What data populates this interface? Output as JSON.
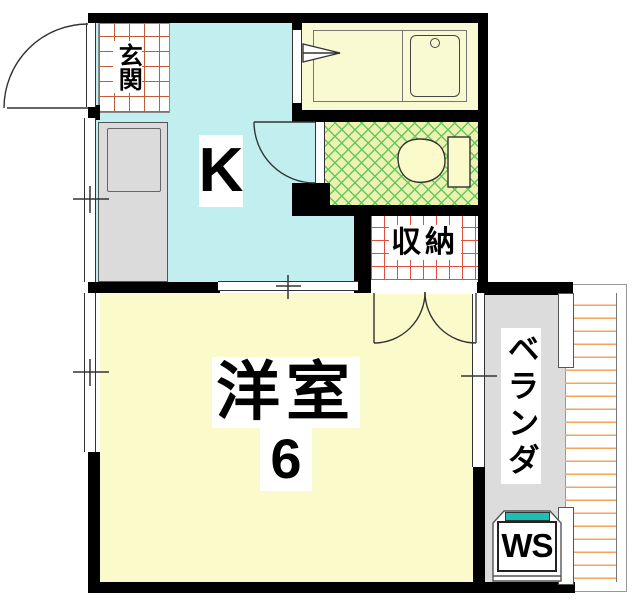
{
  "floorplan": {
    "labels": {
      "entrance": "玄関",
      "kitchen": "K",
      "closet": "収納",
      "main_room_name": "洋室",
      "main_room_size": "6",
      "balcony": "ベランダ",
      "washer_space": "WS"
    },
    "colors": {
      "kitchen_floor": "#c1efef",
      "room_floor": "#fafacb",
      "bathroom_floor": "#fafad2",
      "toilet_floor": "#f0f0b2",
      "toilet_hatch": "#5ccd5c",
      "balcony_floor": "#dcdcdc",
      "counter": "#dbdbdb",
      "wall": "#000000",
      "entrance_grid": "#c05c38",
      "closet_grid": "#e05040",
      "railing_lines": "#f2a55c",
      "washer_accent": "#1cbfb4"
    }
  }
}
